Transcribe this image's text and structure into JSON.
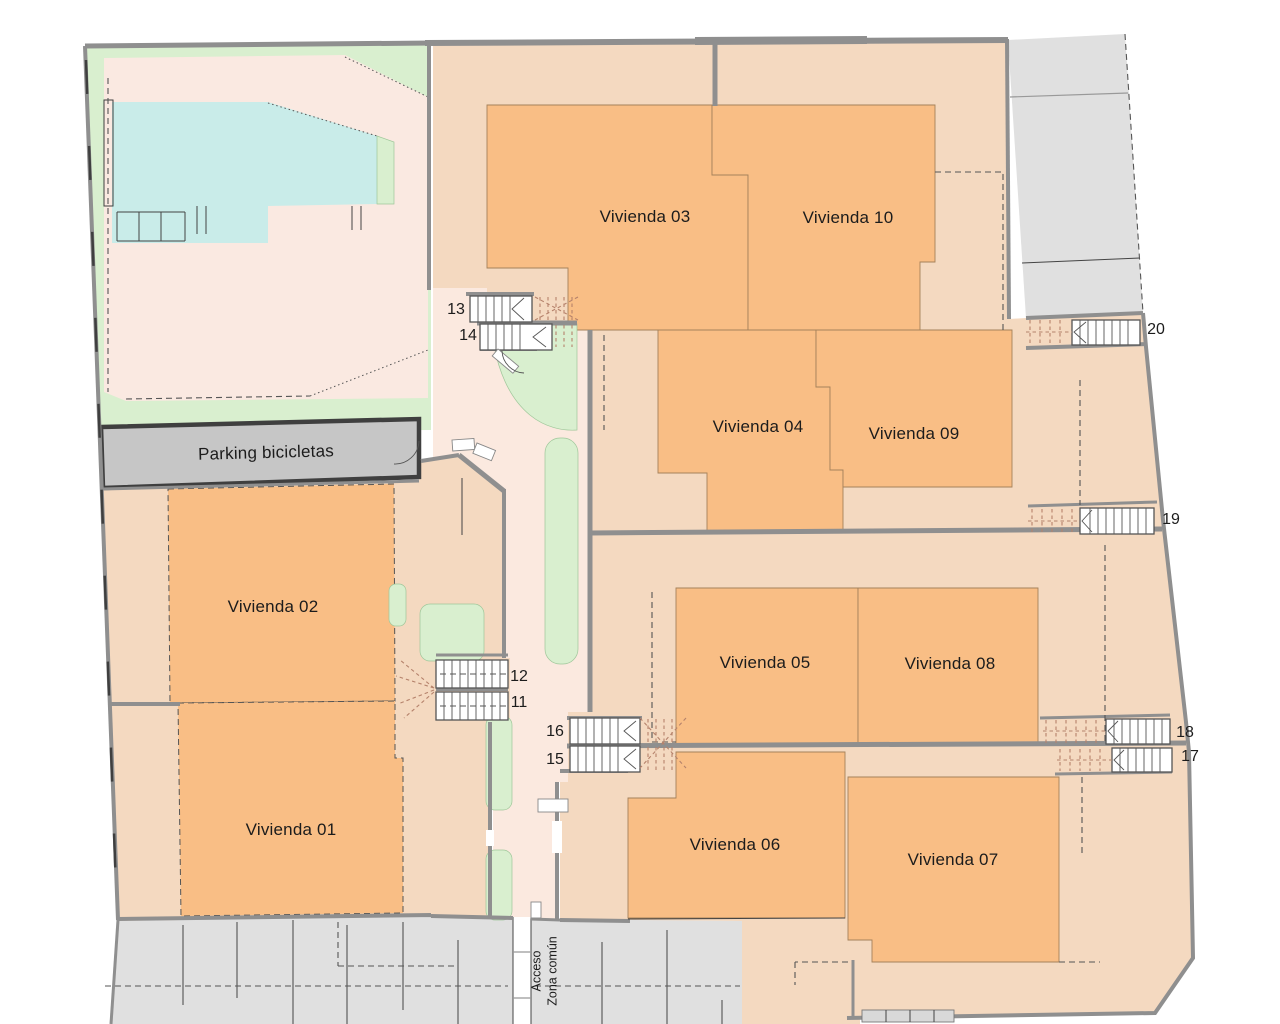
{
  "units": [
    {
      "id": "vivienda-01",
      "label": "Vivienda 01"
    },
    {
      "id": "vivienda-02",
      "label": "Vivienda 02"
    },
    {
      "id": "vivienda-03",
      "label": "Vivienda 03"
    },
    {
      "id": "vivienda-04",
      "label": "Vivienda 04"
    },
    {
      "id": "vivienda-05",
      "label": "Vivienda 05"
    },
    {
      "id": "vivienda-06",
      "label": "Vivienda 06"
    },
    {
      "id": "vivienda-07",
      "label": "Vivienda 07"
    },
    {
      "id": "vivienda-08",
      "label": "Vivienda 08"
    },
    {
      "id": "vivienda-09",
      "label": "Vivienda 09"
    },
    {
      "id": "vivienda-10",
      "label": "Vivienda 10"
    }
  ],
  "facilities": {
    "parking_label": "Parking bicicletas",
    "access_line1": "Acceso",
    "access_line2": "Zona común"
  },
  "stairs": [
    {
      "num": "11"
    },
    {
      "num": "12"
    },
    {
      "num": "13"
    },
    {
      "num": "14"
    },
    {
      "num": "15"
    },
    {
      "num": "16"
    },
    {
      "num": "17"
    },
    {
      "num": "18"
    },
    {
      "num": "19"
    },
    {
      "num": "20"
    }
  ],
  "colors": {
    "unit_fill": "#F9BE85",
    "terrace_fill": "#F4D9C0",
    "courtyard_fill": "#FBE9DF",
    "garden_fill": "#FAE9E1",
    "green_fill": "#D9EFCF",
    "pool_fill": "#C9ECE9",
    "neighbor_fill": "#E0E0E0",
    "street_fill": "#E0E0E0",
    "parking_fill": "#C6C6C6",
    "wall": "#8F8F8F",
    "dark_wall": "#3F3F3F",
    "stair_dash": "#B5826B",
    "text": "#1C1C1C"
  }
}
